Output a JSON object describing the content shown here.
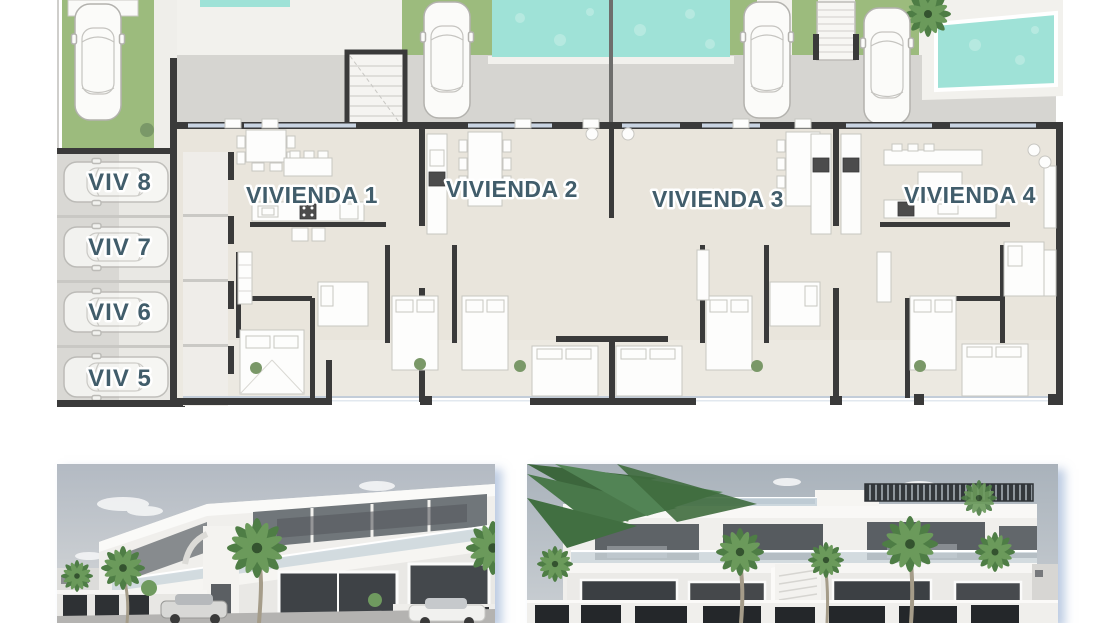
{
  "page": {
    "background": "#ffffff"
  },
  "floor_plan": {
    "units": [
      {
        "id": "vivienda-1",
        "label": "VIVIENDA 1"
      },
      {
        "id": "vivienda-2",
        "label": "VIVIENDA 2"
      },
      {
        "id": "vivienda-3",
        "label": "VIVIENDA 3"
      },
      {
        "id": "vivienda-4",
        "label": "VIVIENDA 4"
      }
    ],
    "parking_spaces": [
      {
        "id": "viv-8",
        "label": "VIV 8"
      },
      {
        "id": "viv-7",
        "label": "VIV 7"
      },
      {
        "id": "viv-6",
        "label": "VIV 6"
      },
      {
        "id": "viv-5",
        "label": "VIV 5"
      }
    ],
    "colors": {
      "wall": "#3a3a3a",
      "floor": "#e9e5dc",
      "terrace": "#ece9e1",
      "pool": "#9fe2d7",
      "grass": "#9cbb7d",
      "driveway": "#d6d5d1",
      "deck": "#f2f1ed",
      "glazing": "#c9d4e2",
      "label_text": "#415d6b",
      "plant": "#7a9868",
      "fence": "#6e6e6c"
    },
    "icons": {
      "car": "car-icon",
      "palm_tree": "palm-tree-icon",
      "plant": "plant-icon",
      "staircase": "staircase-icon",
      "pool": "pool"
    }
  },
  "renders": [
    {
      "id": "exterior-render-left"
    },
    {
      "id": "exterior-render-right"
    }
  ]
}
